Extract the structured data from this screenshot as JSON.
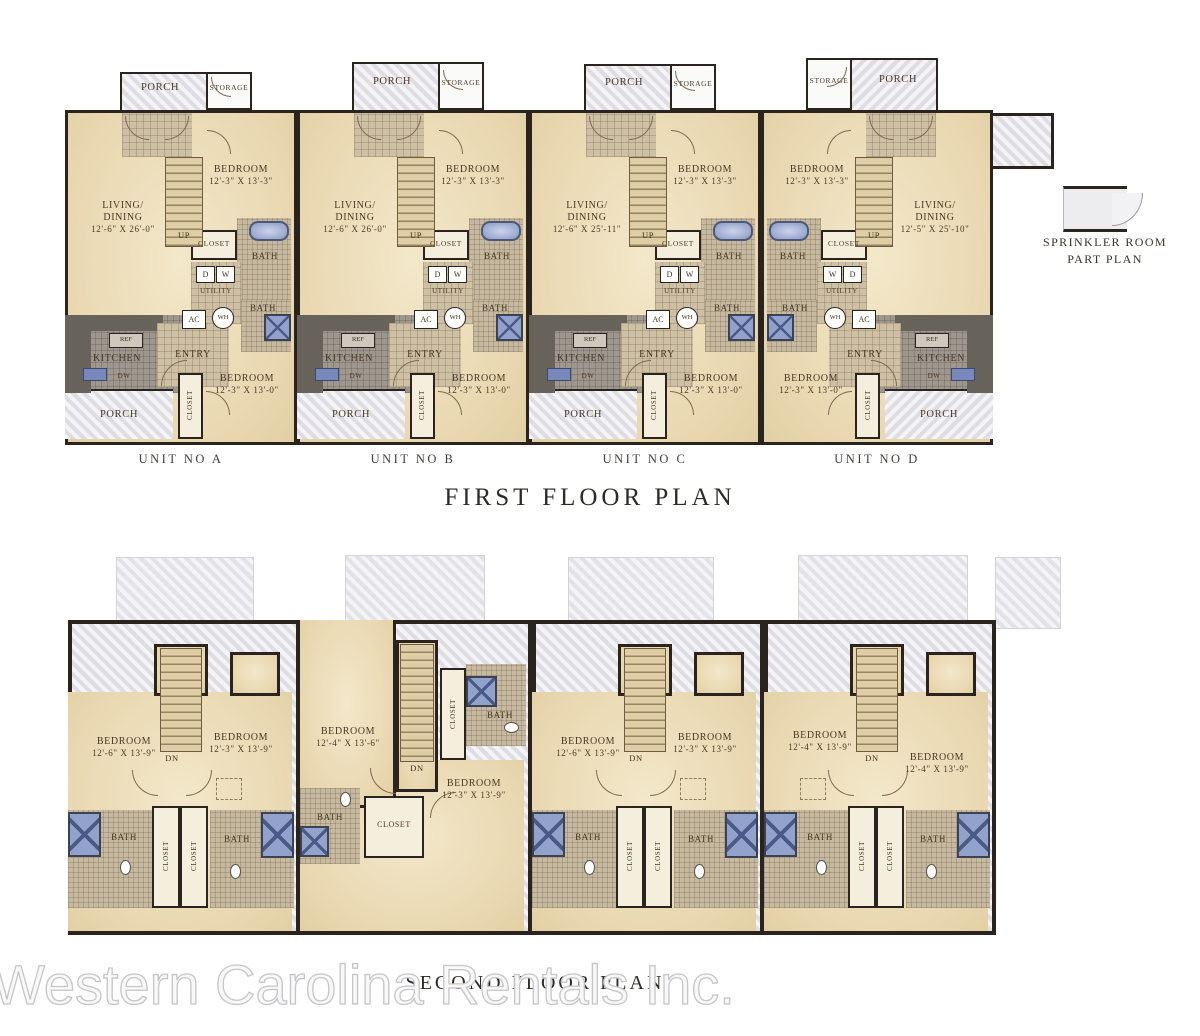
{
  "watermark": "Western Carolina Rentals Inc.",
  "labels": {
    "porch": "PORCH",
    "storage": "STORAGE",
    "bedroom": "BEDROOM",
    "closet": "CLOSET",
    "bath": "BATH",
    "utility": "UTILITY",
    "kitchen": "KITCHEN",
    "entry": "ENTRY",
    "ref": "REF",
    "dw": "DW",
    "ac": "AC",
    "wh": "WH",
    "washer_d": "D",
    "washer_w": "W",
    "up": "UP",
    "dn": "DN",
    "living_line1": "LIVING/",
    "living_line2": "DINING"
  },
  "first_floor": {
    "title": "FIRST FLOOR PLAN",
    "units": [
      {
        "name": "UNIT NO A",
        "bedroom1_dims": "12'-3\" X 13'-3\"",
        "living_dims": "12'-6\" X 26'-0\"",
        "bedroom2_dims": "12'-3\" X 13'-0\""
      },
      {
        "name": "UNIT NO B",
        "bedroom1_dims": "12'-3\" X 13'-3\"",
        "living_dims": "12'-6\" X 26'-0\"",
        "bedroom2_dims": "12'-3\" X 13'-0\""
      },
      {
        "name": "UNIT NO C",
        "bedroom1_dims": "12'-3\" X 13'-3\"",
        "living_dims": "12'-6\" X 25'-11\"",
        "bedroom2_dims": "12'-3\" X 13'-0\""
      },
      {
        "name": "UNIT NO D",
        "bedroom1_dims": "12'-3\" X 13'-3\"",
        "living_dims": "12'-5\" X 25'-10\"",
        "bedroom2_dims": "12'-3\" X 13'-0\""
      }
    ]
  },
  "second_floor": {
    "title": "SECOND FLOOR PLAN",
    "units": [
      {
        "bedroom_left_dims": "12'-6\" X 13'-9\"",
        "bedroom_right_dims": "12'-3\" X 13'-9\""
      },
      {
        "bedroom_top_dims": "12'-4\" X 13'-6\"",
        "bedroom_bottom_dims": "12'-3\" X 13'-9\""
      },
      {
        "bedroom_left_dims": "12'-6\" X 13'-9\"",
        "bedroom_right_dims": "12'-3\" X 13'-9\""
      },
      {
        "bedroom_left_dims": "12'-4\" X 13'-9\"",
        "bedroom_right_dims": "12'-4\" X 13'-9\""
      }
    ]
  },
  "sprinkler": {
    "line1": "SPRINKLER ROOM",
    "line2": "PART PLAN"
  },
  "colors": {
    "wall": "#2b241e",
    "floor_tan": "#ecdcb6",
    "porch_gray": "#e5e5e9",
    "fixture_blue": "#93a2cb",
    "label_brown": "#4a3826"
  }
}
